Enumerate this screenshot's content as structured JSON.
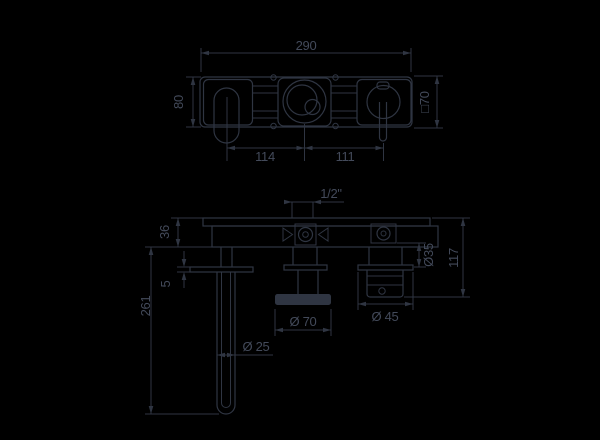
{
  "page": {
    "width": 600,
    "height": 440,
    "kind": "faucet technical dimension drawing"
  },
  "colors": {
    "background": "#000000",
    "line": "#2f3542",
    "text": "#434a5a"
  },
  "drawing": {
    "front_view": {
      "label": "front elevation",
      "dims": {
        "overall_width": "290",
        "plate_height": "80",
        "spout_to_center": "114",
        "center_to_handle": "111",
        "square_escutcheon": "□70"
      }
    },
    "section_view": {
      "label": "side section",
      "dims": {
        "inlet_connection": "1/2\"",
        "plate_depth": "36",
        "escutcheon_thickness": "5",
        "spout_projection": "261",
        "spout_tube_diameter": "Ø 25",
        "mixer_knob_diameter": "Ø 70",
        "handle_diameter": "Ø 45",
        "handle_sleeve_diameter": "Ø35",
        "handle_projection": "117"
      }
    }
  }
}
